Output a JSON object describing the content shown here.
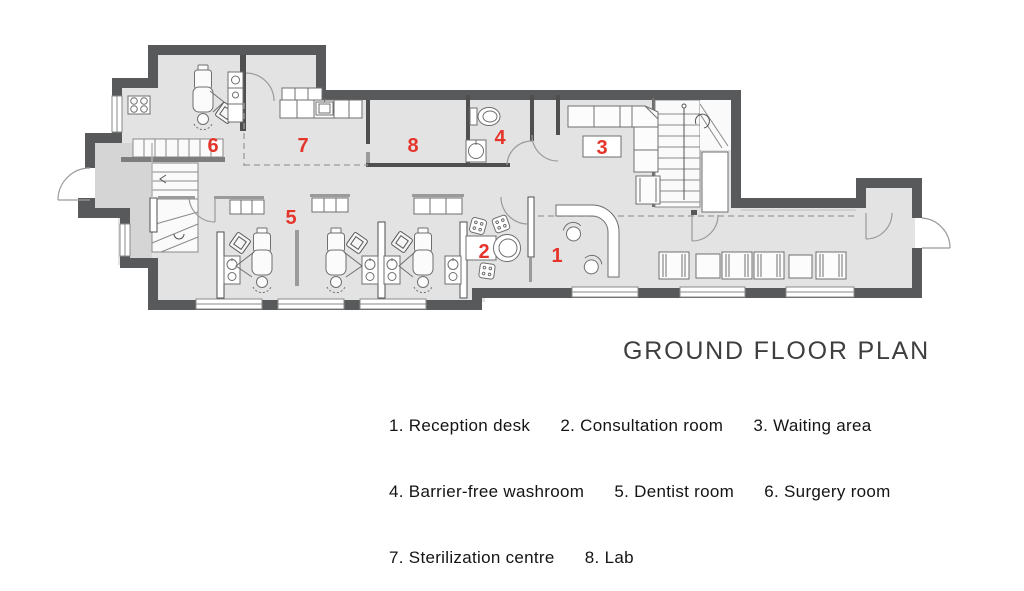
{
  "plan": {
    "title": "GROUND FLOOR PLAN",
    "rooms": [
      {
        "num": "1",
        "name": "Reception desk"
      },
      {
        "num": "2",
        "name": "Consultation room"
      },
      {
        "num": "3",
        "name": "Waiting area"
      },
      {
        "num": "4",
        "name": "Barrier-free washroom"
      },
      {
        "num": "5",
        "name": "Dentist room"
      },
      {
        "num": "6",
        "name": "Surgery room"
      },
      {
        "num": "7",
        "name": "Sterilization centre"
      },
      {
        "num": "8",
        "name": "Lab"
      }
    ],
    "colors": {
      "wall": "#58595b",
      "floor": "#e3e3e3",
      "vestibule": "#d5d5d5",
      "accent_red": "#e5352b",
      "line_gray": "#6f6f6f"
    }
  },
  "legend": {
    "lines": [
      "1. Reception desk      2. Consultation room      3. Waiting area",
      "4. Barrier-free washroom      5. Dentist room      6. Surgery room",
      "7. Sterilization centre      8. Lab"
    ]
  }
}
